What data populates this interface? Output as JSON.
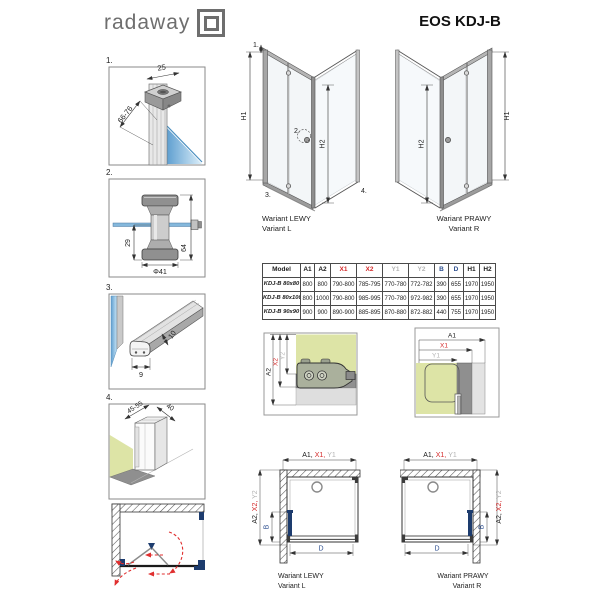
{
  "colors": {
    "dim_red": "#d42a2a",
    "dim_gray": "#b4b4b4",
    "dim_blue": "#2b4d8e",
    "navy": "#1d3c6e",
    "wall_green": "#dde4a6",
    "glass_blue": "#85b8dc"
  },
  "header": {
    "logo_text": "radaway",
    "title": "EOS KDJ-B"
  },
  "details": {
    "d1": {
      "num": "1.",
      "dim_top": "25",
      "dim_side": "66-76"
    },
    "d2": {
      "num": "2.",
      "dim_inner": "29",
      "dim_dia": "Φ41",
      "dim_outer": "64"
    },
    "d3": {
      "num": "3.",
      "dim_w": "9",
      "dim_h": "10"
    },
    "d4": {
      "num": "4.",
      "dim_range": "45-55",
      "dim_depth": "40"
    }
  },
  "iso": {
    "left": {
      "h1": "H1",
      "h2": "H2",
      "c1": "1.",
      "c2": "2.",
      "c3": "3.",
      "c4": "4.",
      "cap1": "Wariant LEWY",
      "cap2": "Variant L"
    },
    "right": {
      "h1": "H1",
      "h2": "H2",
      "cap1": "Wariant PRAWY",
      "cap2": "Variant R"
    }
  },
  "table": {
    "h": [
      "Model",
      "A1",
      "A2",
      "X1",
      "X2",
      "Y1",
      "Y2",
      "B",
      "D",
      "H1",
      "H2"
    ],
    "rows": [
      [
        "KDJ-B 80x80",
        "800",
        "800",
        "790-800",
        "785-795",
        "770-780",
        "772-782",
        "390",
        "655",
        "1970",
        "1950"
      ],
      [
        "KDJ-B 80x100",
        "800",
        "1000",
        "790-800",
        "985-995",
        "770-780",
        "972-982",
        "390",
        "655",
        "1970",
        "1950"
      ],
      [
        "KDJ-B 90x90",
        "900",
        "900",
        "890-900",
        "885-895",
        "870-880",
        "872-882",
        "440",
        "755",
        "1970",
        "1950"
      ]
    ]
  },
  "sections": {
    "vert": {
      "a2": "A2",
      "x2": "X2",
      "y2": "Y2"
    },
    "horiz": {
      "a1": "A1",
      "x1": "X1",
      "y1": "Y1"
    }
  },
  "plans": {
    "left": {
      "ta": "A1,",
      "tx": "X1,",
      "ty": "Y1",
      "sa": "A2, ",
      "sx": "X2, ",
      "sy": "Y2",
      "b": "B",
      "d": "D",
      "cap1": "Wariant LEWY",
      "cap2": "Variant L"
    },
    "right": {
      "ta": "A1,",
      "tx": "X1,",
      "ty": "Y1",
      "sa": "A2, ",
      "sx": "X2, ",
      "sy": "Y2",
      "b": "B",
      "d": "D",
      "cap1": "Wariant PRAWY",
      "cap2": "Variant R"
    }
  }
}
